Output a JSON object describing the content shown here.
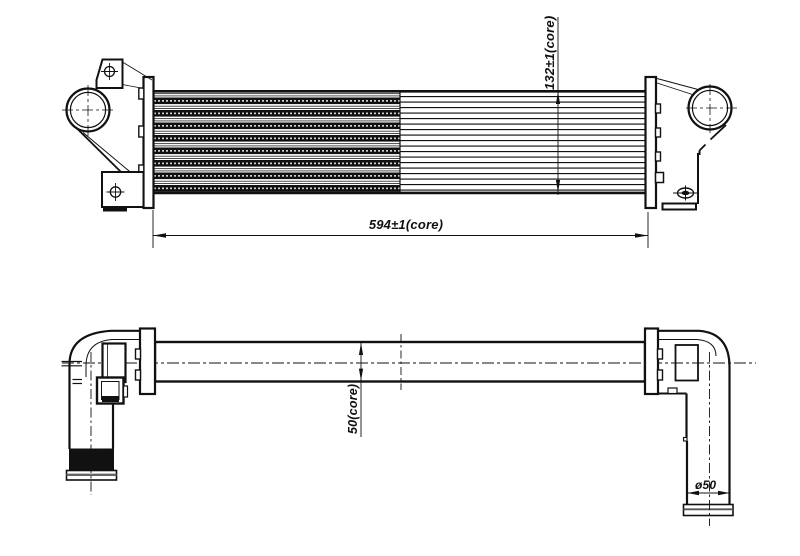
{
  "drawing": {
    "kind": "intercooler technical drawing, front view and plan view",
    "colors": {
      "line": "#111111",
      "background": "#ffffff"
    },
    "dimensions": {
      "core_width_label": "594±1(core)",
      "core_height_label": "132±1(core)",
      "core_depth_label": "50(core)",
      "pipe_diameter_label": "ø50"
    }
  }
}
